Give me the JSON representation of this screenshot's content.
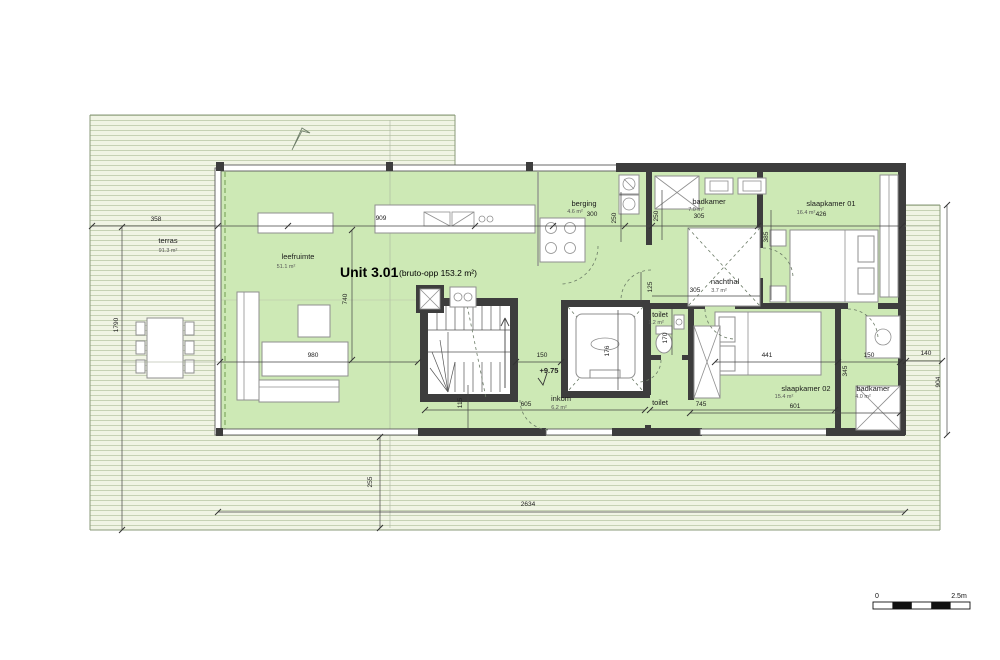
{
  "title": {
    "unit": "Unit 3.01",
    "gross_area": "(bruto-opp 153.2 m²)"
  },
  "level_marker": "+9.75",
  "scale_bar": {
    "start": "0",
    "end": "2.5m"
  },
  "rooms": {
    "terras": {
      "name": "terras",
      "area": "91.3 m²"
    },
    "leefruimte": {
      "name": "leefruimte",
      "area": "51.1 m²"
    },
    "berging": {
      "name": "berging",
      "area": "4.6 m²"
    },
    "badkamer1": {
      "name": "badkamer",
      "area": "7.0 m²"
    },
    "slaapkamer1": {
      "name": "slaapkamer 01",
      "area": "16.4 m²"
    },
    "nachthal": {
      "name": "nachthal",
      "area": "3.7 m²"
    },
    "toilet1": {
      "name": "toilet",
      "area": "1.2 m²"
    },
    "inkom": {
      "name": "inkom",
      "area": "6.2 m²"
    },
    "toilet2": {
      "name": "toilet",
      "area": ""
    },
    "slaapkamer2": {
      "name": "slaapkamer 02",
      "area": "15.4 m²"
    },
    "badkamer2": {
      "name": "badkamer",
      "area": "4.0 m²"
    }
  },
  "dims": {
    "d358": "358",
    "d909": "909",
    "d300": "300",
    "d250a": "250",
    "d250b": "250",
    "d305_badkamer": "305",
    "d385": "385",
    "d426": "426",
    "d1790": "1790",
    "d740": "740",
    "d980": "980",
    "d150_hall": "150",
    "d176": "176",
    "d170": "170",
    "d125": "125",
    "d305_nachthal": "305",
    "d605": "605",
    "d115": "115",
    "d745": "745",
    "d441": "441",
    "d345": "345",
    "d150_badkamer": "150",
    "d140": "140",
    "d904": "904",
    "d601": "601",
    "d255": "255",
    "d2634": "2634"
  },
  "colors": {
    "unit_fill": "#cde9b5",
    "terrace_bg": "#f0f4e4",
    "terrace_line": "#c6d2b4",
    "wall": "#3d3d3d",
    "dimension": "#444444",
    "boundary_dash": "#6f9b4f"
  }
}
